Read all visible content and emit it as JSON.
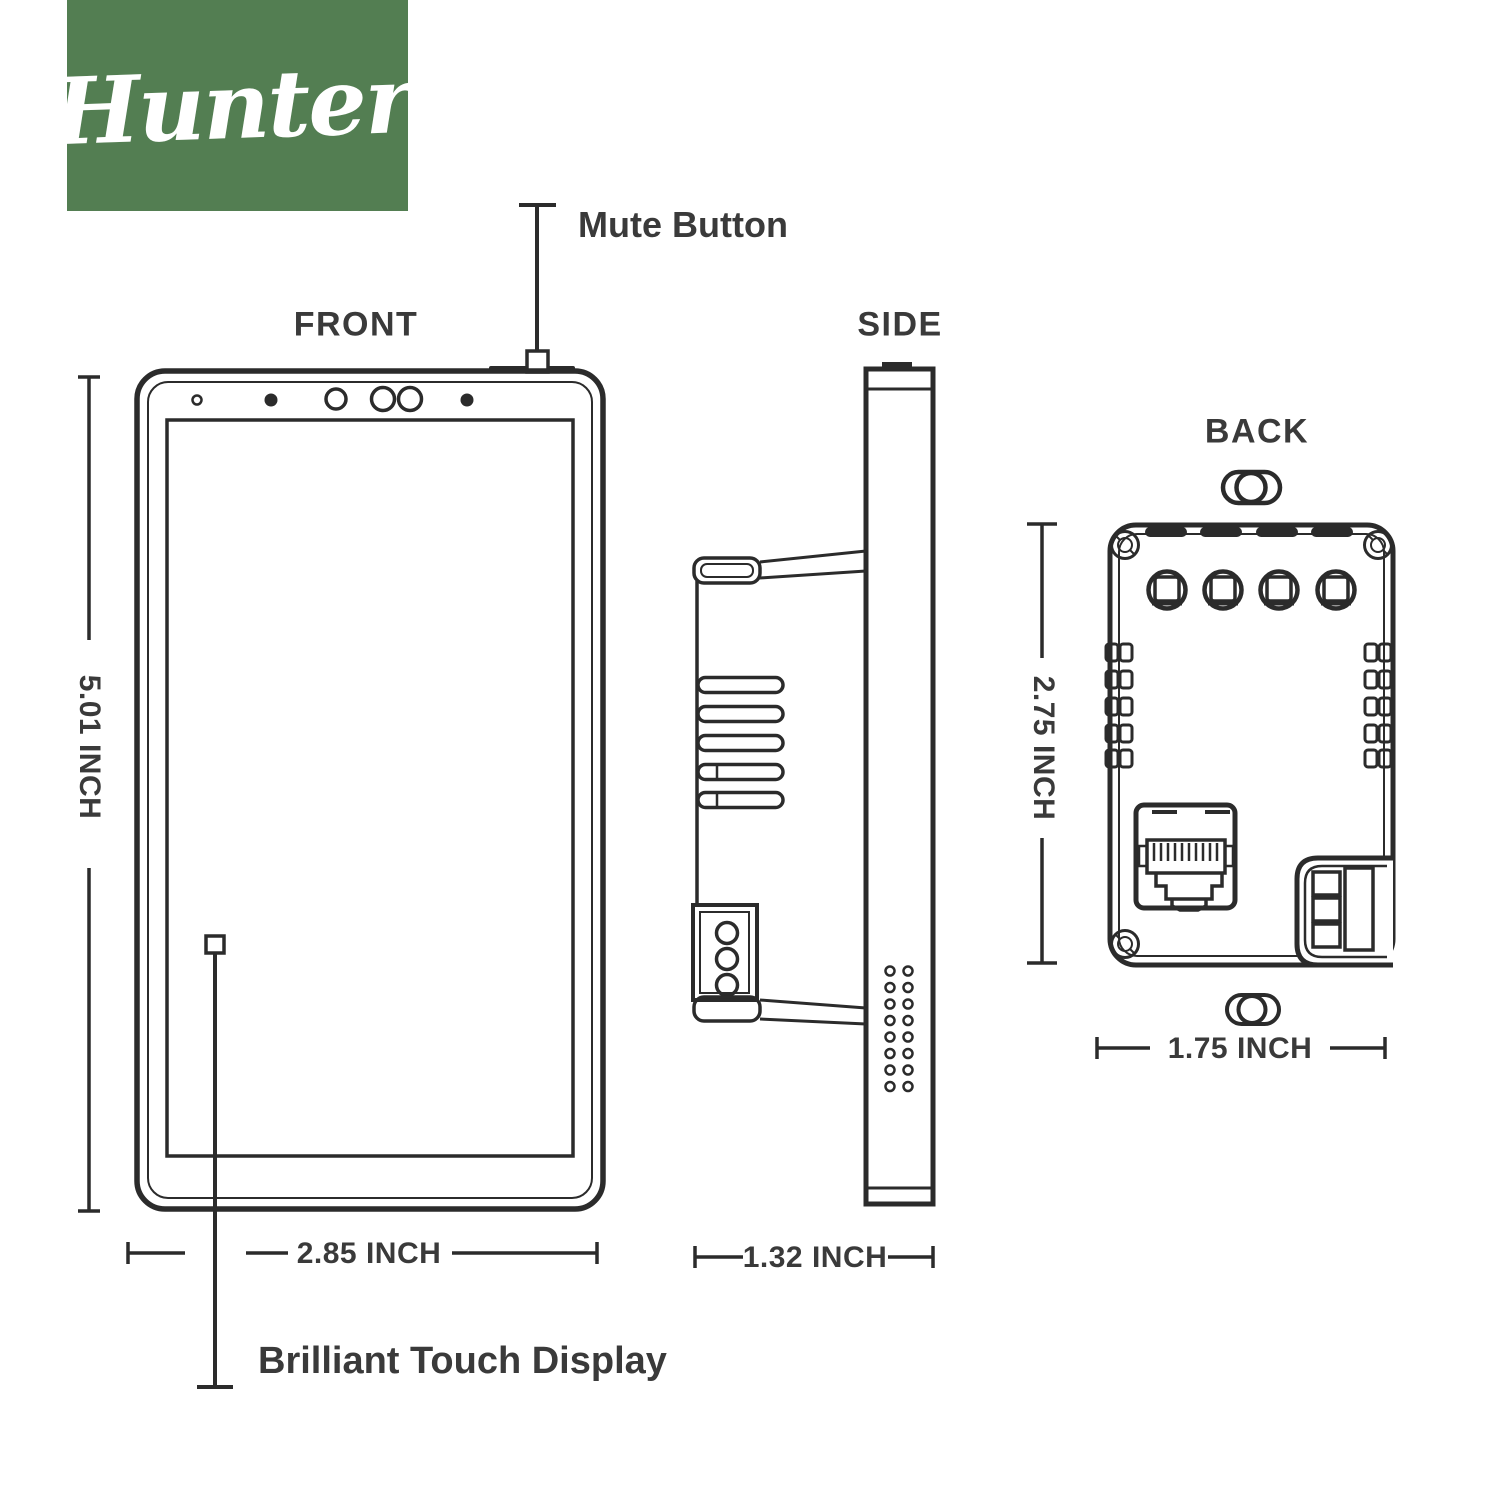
{
  "logo": {
    "text": "Hunter",
    "mark": ".",
    "background_color": "#537e52",
    "text_color": "#ffffff"
  },
  "palette": {
    "line_color": "#2b2b2b",
    "label_color": "#3a3a3a",
    "background": "#ffffff"
  },
  "view_labels": {
    "front": "FRONT",
    "side": "SIDE",
    "back": "BACK"
  },
  "callouts": {
    "mute_button": "Mute Button",
    "touch_display": "Brilliant Touch Display"
  },
  "dimensions": {
    "front_height": "5.01 INCH",
    "front_width": "2.85 INCH",
    "side_depth": "1.32 INCH",
    "back_height": "2.75 INCH",
    "back_width": "1.75 INCH"
  }
}
